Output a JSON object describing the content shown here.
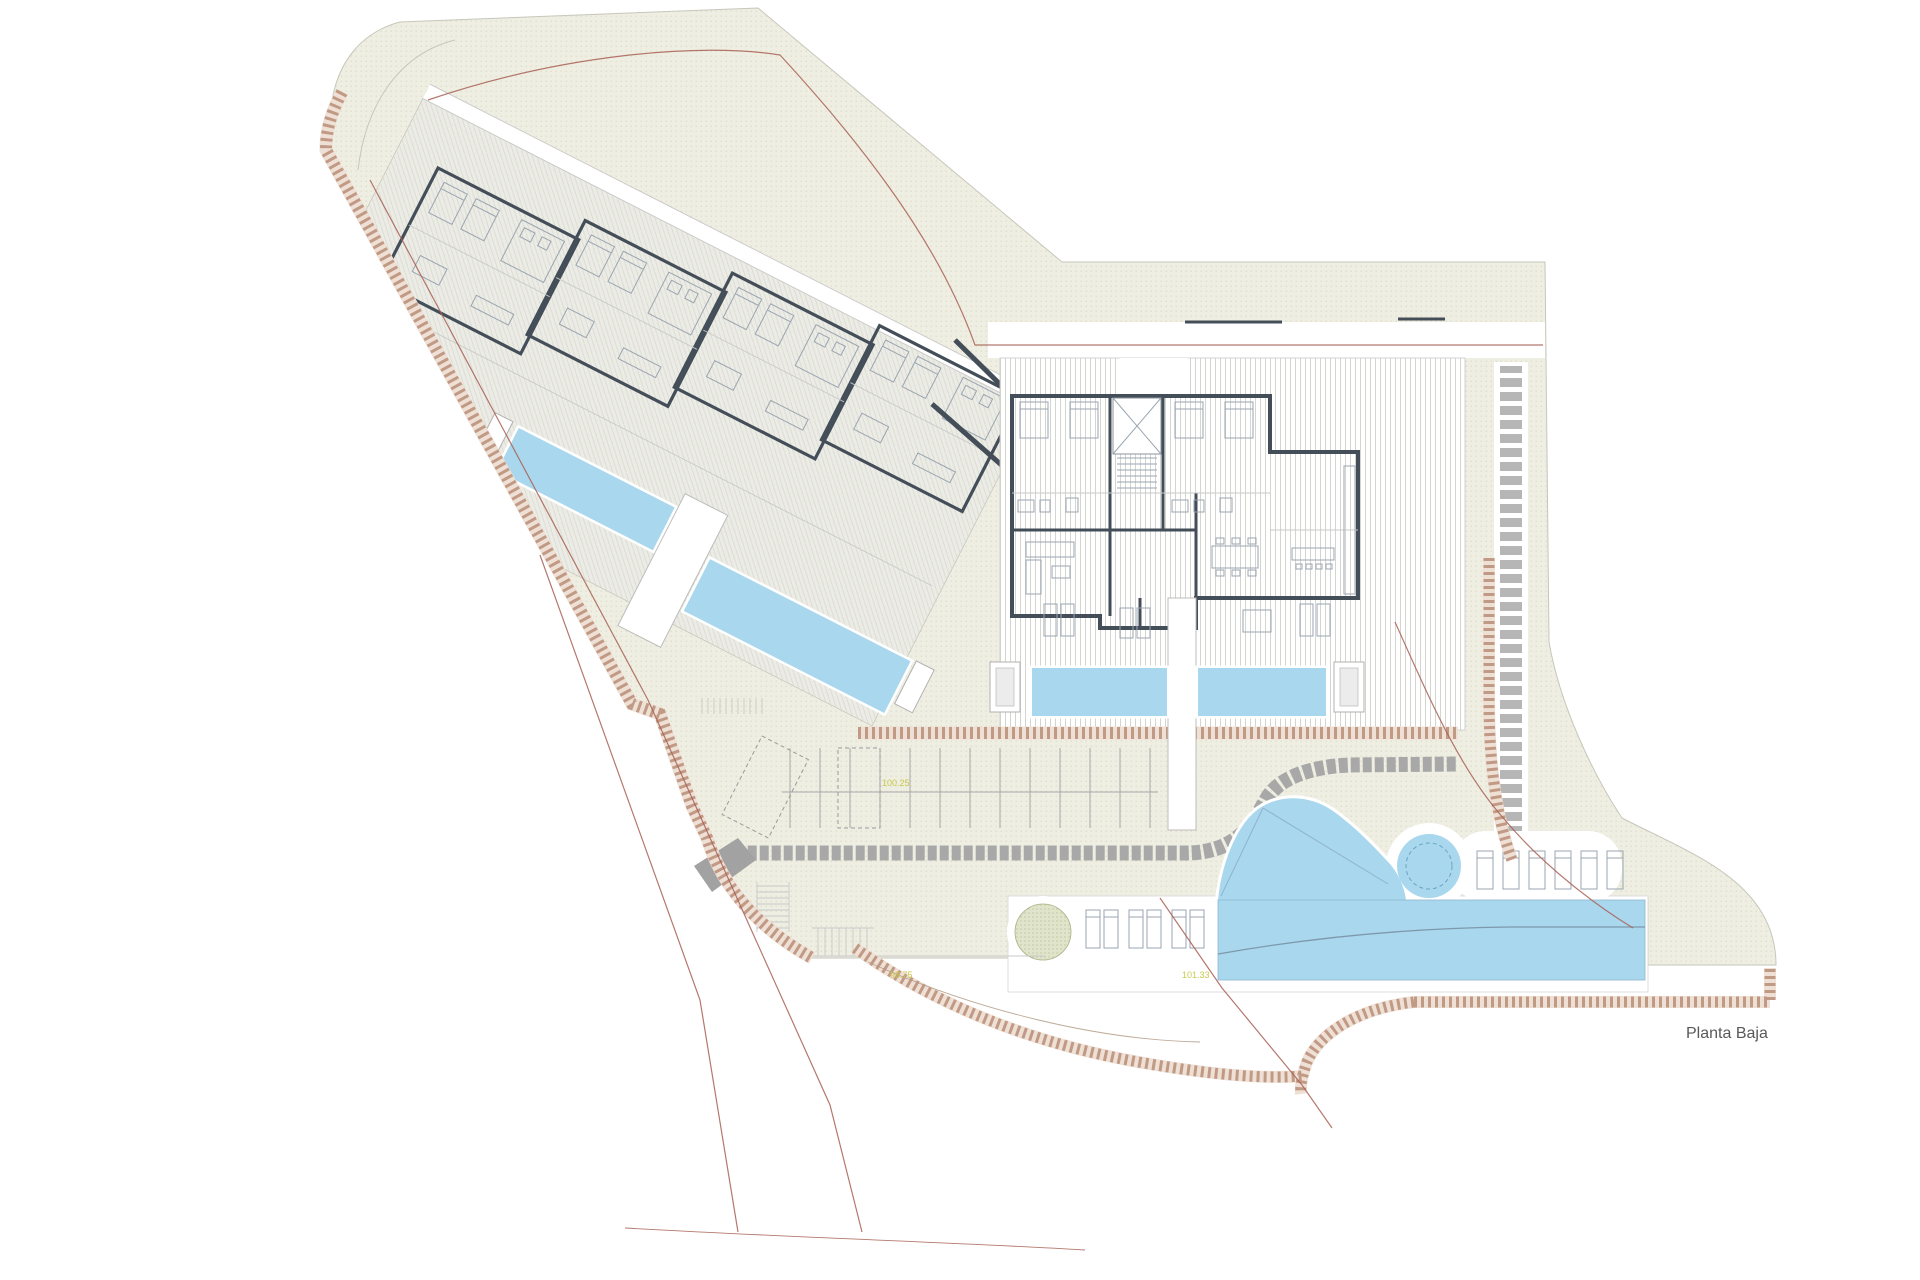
{
  "plan": {
    "title": "Planta Baja"
  },
  "labels": {
    "elevation_parking": "100.25",
    "elevation_path": "98.75",
    "elevation_pool": "101.33"
  },
  "colors": {
    "site_fill": "#efeee2",
    "pool_blue": "#a9d7ee",
    "wall_dark": "#434e58",
    "rockery_tan": "#b98d77",
    "boundary_red": "#a86055",
    "road_gray": "#a8a8a8",
    "tree_green": "#dfe4cb",
    "label_yellow": "#c9c94f",
    "title_text": "#595959"
  }
}
